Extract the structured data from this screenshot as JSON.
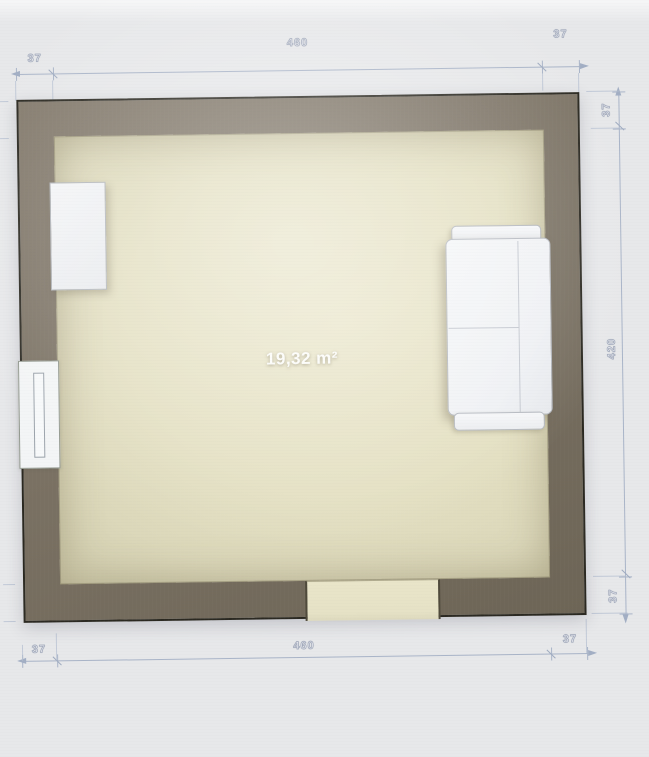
{
  "room": {
    "area_label": "19,32 m²"
  },
  "dimensions": {
    "top": {
      "left": "37",
      "span": "460",
      "right": "37"
    },
    "right": {
      "top": "37",
      "span": "420",
      "bottom": "37"
    },
    "bottom": {
      "left": "37",
      "span": "460",
      "right": "37"
    }
  },
  "elements": [
    {
      "type": "walls"
    },
    {
      "type": "window"
    },
    {
      "type": "door-opening"
    },
    {
      "type": "sideboard"
    },
    {
      "type": "sofa"
    }
  ],
  "colors": {
    "wall": "#7b7264",
    "wall_outline": "#2a2820",
    "floor": "#e4e0c2",
    "canvas": "#e7e8ea",
    "dimension_line": "#a9b4c8",
    "furniture": "#f3f4f6"
  }
}
